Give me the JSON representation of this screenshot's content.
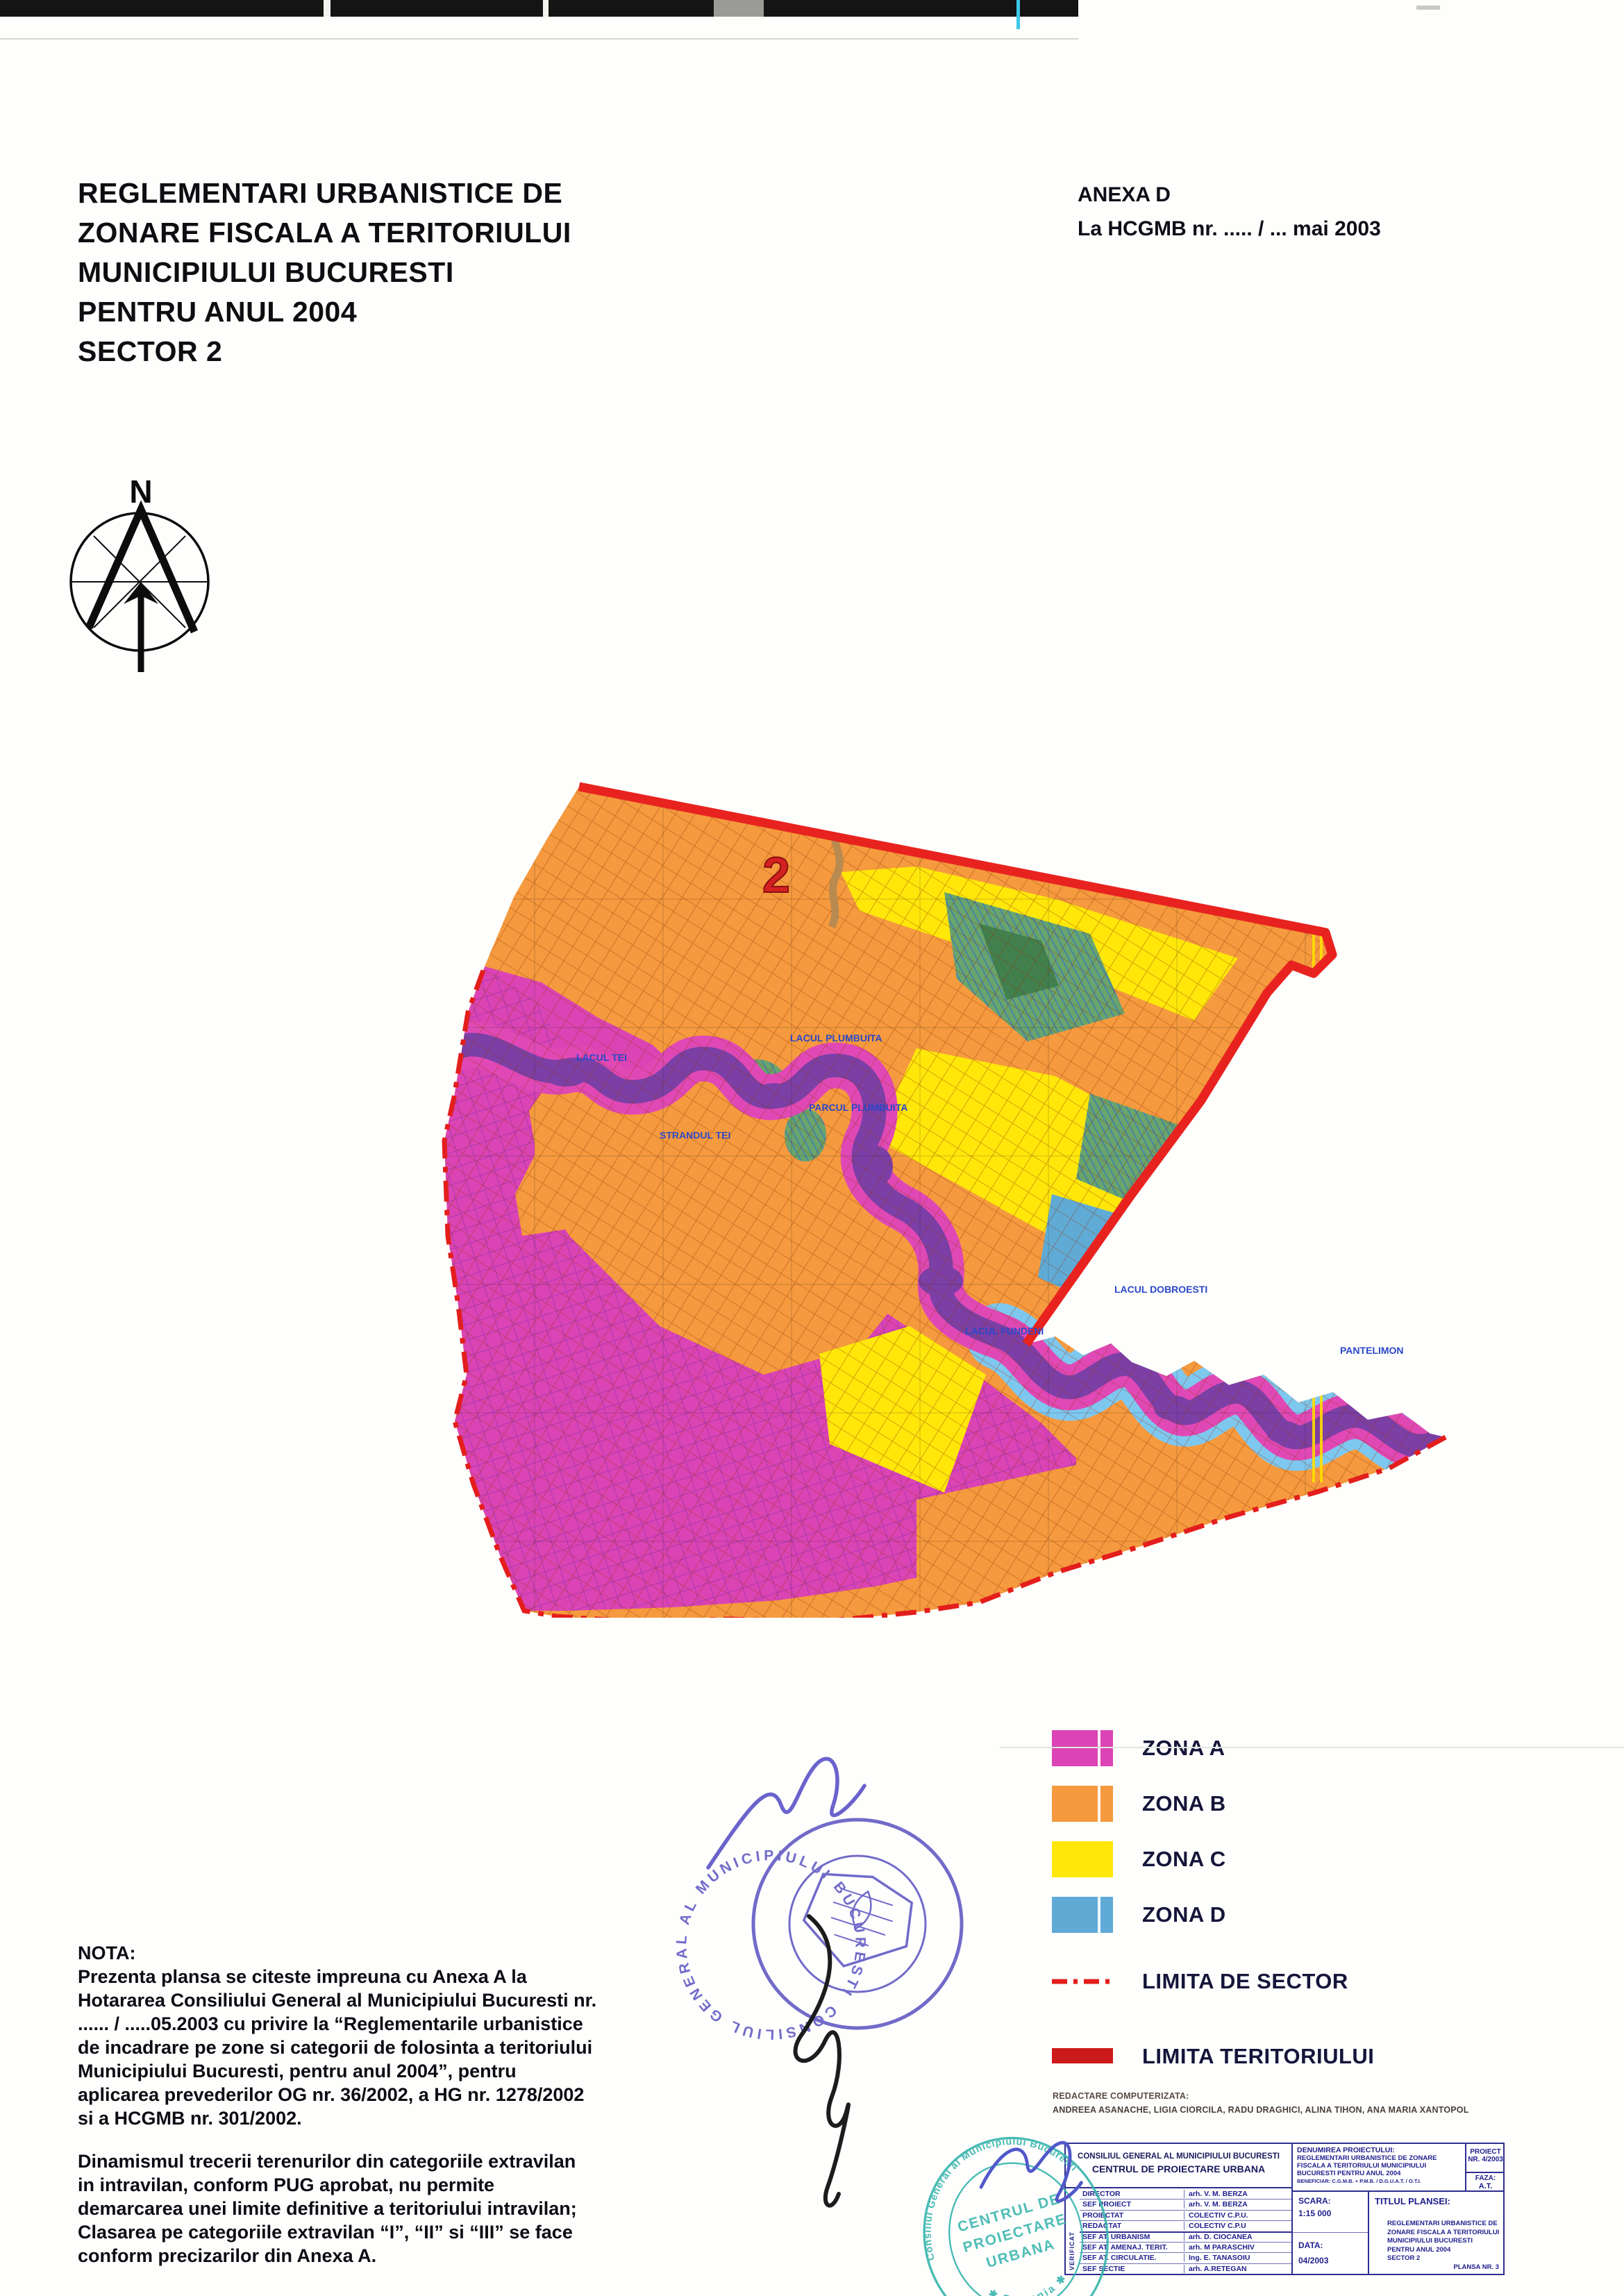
{
  "header": {
    "title_lines": [
      "REGLEMENTARI URBANISTICE DE",
      "ZONARE FISCALA A TERITORIULUI",
      "MUNICIPIULUI BUCURESTI",
      "PENTRU ANUL 2004",
      "SECTOR 2"
    ],
    "anexa_line1": "ANEXA D",
    "anexa_line2": "La HCGMB nr. ..... / ... mai 2003"
  },
  "compass": {
    "north_label": "N"
  },
  "map": {
    "sector_number": "2",
    "colors": {
      "zona_a": "#DB44B4",
      "zona_b": "#F59A3E",
      "zona_c": "#FFE70A",
      "zona_d": "#5FABD6",
      "river": "#7B3FA6",
      "river_bank": "#E049B5",
      "lake_edge": "#7EC8F0",
      "limita_teritoriului": "#E8231F",
      "limita_sector": "#E31E1C"
    },
    "labels": [
      {
        "text": "LACUL TEI"
      },
      {
        "text": "STRANDUL TEI"
      },
      {
        "text": "LACUL PLUMBUITA"
      },
      {
        "text": "PARCUL PLUMBUITA"
      },
      {
        "text": "LACUL FUNDENI"
      },
      {
        "text": "LACUL DOBROESTI"
      },
      {
        "text": "PANTELIMON"
      }
    ]
  },
  "legend": {
    "items": [
      {
        "label": "ZONA A",
        "color": "#DB44B4"
      },
      {
        "label": "ZONA B",
        "color": "#F59A3E"
      },
      {
        "label": "ZONA C",
        "color": "#FFE70A"
      },
      {
        "label": "ZONA D",
        "color": "#5FABD6"
      },
      {
        "label": "LIMITA DE SECTOR",
        "color": "#E3201C",
        "style": "dash-dot"
      },
      {
        "label": "LIMITA TERITORIULUI",
        "color": "#CC1A1A",
        "style": "solid"
      }
    ],
    "credits_line1": "REDACTARE COMPUTERIZATA:",
    "credits_line2": "ANDREEA ASANACHE, LIGIA CIORCILA, RADU DRAGHICI, ALINA TIHON, ANA MARIA XANTOPOL"
  },
  "nota": {
    "heading": "NOTA:",
    "para1_lines": [
      "Prezenta plansa se citeste impreuna cu Anexa A la",
      "Hotararea Consiliului General al Municipiului Bucuresti nr.",
      "...... / .....05.2003 cu privire la “Reglementarile urbanistice",
      "de incadrare pe zone si categorii de folosinta a teritoriului",
      "Municipiului Bucuresti, pentru anul 2004”, pentru",
      "aplicarea prevederilor OG nr. 36/2002, a HG nr. 1278/2002",
      "si a HCGMB nr. 301/2002."
    ],
    "para2_lines": [
      "Dinamismul trecerii terenurilor din categoriile extravilan",
      "in intravilan, conform PUG aprobat, nu permite",
      "demarcarea unei limite definitive a teritoriului intravilan;",
      "Clasarea pe categoriile extravilan “I”, “II” si “III” se face",
      "conform precizarilor din Anexa A."
    ]
  },
  "round_stamp": {
    "ring_text": "CONSILIUL GENERAL AL MUNICIPIULUI BUCURESTI ✱ ROMANIA ✱"
  },
  "teal_stamp": {
    "ring_top": "Consiliul General al Municipiului Bucuresti",
    "ring_bottom": "✱ Romania ✱",
    "center_line1": "CENTRUL DE",
    "center_line2": "PROIECTARE",
    "center_line3": "URBANA"
  },
  "titleblock": {
    "org_line1": "CONSILIUL GENERAL AL MUNICIPIULUI BUCURESTI",
    "org_line2": "CENTRUL DE PROIECTARE URBANA",
    "verificat_label": "VERIFICAT",
    "rows": [
      {
        "role": "DIRECTOR",
        "name": "arh. V. M. BERZA"
      },
      {
        "role": "SEF PROIECT",
        "name": "arh. V. M. BERZA"
      },
      {
        "role": "PROIECTAT",
        "name": "COLECTIV C.P.U."
      },
      {
        "role": "REDACTAT",
        "name": "COLECTIV C.P.U"
      },
      {
        "role": "SEF AT. URBANISM",
        "name": "arh. D. CIOCANEA"
      },
      {
        "role": "SEF AT. AMENAJ. TERIT.",
        "name": "arh. M PARASCHIV"
      },
      {
        "role": "SEF AT. CIRCULATIE.",
        "name": "Ing. E. TANASOIU"
      },
      {
        "role": "SEF SECTIE",
        "name": "arh. A.RETEGAN"
      }
    ],
    "denumire_label": "DENUMIREA PROIECTULUI:",
    "denumire_lines": [
      "REGLEMENTARI URBANISTICE DE ZONARE",
      "FISCALA A TERITORIULUI MUNICIPIULUI",
      "BUCURESTI PENTRU ANUL 2004"
    ],
    "beneficiar": "BENEFICIAR: C.G.M.B. + P.M.B. / D.G.U.A.T. / O.T.I.",
    "proiect_label": "PROIECT",
    "proiect_nr": "NR. 4/2003",
    "faza_label": "FAZA:",
    "faza_value": "A.T.",
    "scara_label": "SCARA:",
    "scara_value": "1:15 000",
    "data_label": "DATA:",
    "data_value": "04/2003",
    "titlul_label": "TITLUL PLANSEI:",
    "titlul_lines": [
      "REGLEMENTARI URBANISTICE DE",
      "ZONARE FISCALA A TERITORIULUI",
      "MUNICIPIULUI BUCURESTI",
      "PENTRU ANUL 2004",
      "SECTOR 2"
    ],
    "plansa": "PLANSA NR. 3"
  }
}
